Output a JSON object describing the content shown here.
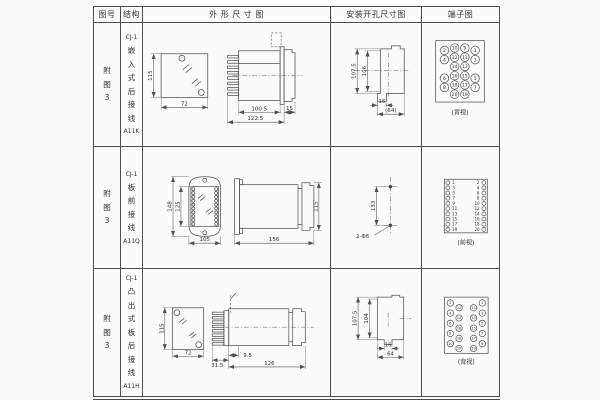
{
  "page": {
    "bg": "#fbfbfb",
    "line_color": "#4d4d4d",
    "text_color": "#2f2f2f"
  },
  "header": {
    "cols": [
      "图号",
      "结构",
      "外 形 尺 寸 图",
      "安装开孔尺寸图",
      "端子图"
    ]
  },
  "rows": [
    {
      "fig": "附\n图\n3",
      "model": "CJ-1",
      "structure": "嵌\n入\n式\n后\n接\n线",
      "code": "A11K",
      "outline": {
        "front_h": "115",
        "front_w": "72",
        "body_w": "100.5",
        "total_w": "122.5",
        "flange": "15"
      },
      "mounting": {
        "outer_h": "107.5",
        "inner_h": "106",
        "tab_w": "16",
        "full_w": "(64)"
      },
      "terminal": {
        "caption": "(背视)",
        "circles_spec": {
          "r": 4.4,
          "font": 4.6,
          "items": [
            {
              "x": 23,
              "y": 27,
              "n": "2"
            },
            {
              "x": 23,
              "y": 36.5,
              "n": "4"
            },
            {
              "x": 23,
              "y": 55.5,
              "n": "6"
            },
            {
              "x": 23,
              "y": 65,
              "n": "8"
            },
            {
              "x": 33.5,
              "y": 24.5,
              "n": "10"
            },
            {
              "x": 33.5,
              "y": 34,
              "n": "12"
            },
            {
              "x": 33.5,
              "y": 43.5,
              "n": "14"
            },
            {
              "x": 33.5,
              "y": 53,
              "n": "16"
            },
            {
              "x": 33.5,
              "y": 62.5,
              "n": "18"
            },
            {
              "x": 33.5,
              "y": 72,
              "n": "20"
            },
            {
              "x": 44,
              "y": 24.5,
              "n": "9"
            },
            {
              "x": 44,
              "y": 34,
              "n": "11"
            },
            {
              "x": 44,
              "y": 43.5,
              "n": "13"
            },
            {
              "x": 44,
              "y": 53,
              "n": "15"
            },
            {
              "x": 44,
              "y": 62.5,
              "n": "17"
            },
            {
              "x": 44,
              "y": 72,
              "n": "19"
            },
            {
              "x": 54.5,
              "y": 27,
              "n": "1"
            },
            {
              "x": 54.5,
              "y": 36.5,
              "n": "3"
            },
            {
              "x": 54.5,
              "y": 55.5,
              "n": "5"
            },
            {
              "x": 54.5,
              "y": 65,
              "n": "7"
            }
          ]
        }
      }
    },
    {
      "fig": "附\n图\n3",
      "model": "CJ-1",
      "structure": "板\n前\n接\n线",
      "code": "A11Q",
      "outline": {
        "outer_h": "148",
        "inner_h": "125",
        "width": "105",
        "side_len": "156",
        "side_h": "115",
        "strips_spec": {
          "r": 1.5,
          "font": 0,
          "items": [
            {
              "x": 50.5,
              "y": 42.5
            },
            {
              "x": 50.5,
              "y": 46.4
            },
            {
              "x": 50.5,
              "y": 50.3
            },
            {
              "x": 50.5,
              "y": 54.2
            },
            {
              "x": 50.5,
              "y": 58.1
            },
            {
              "x": 50.5,
              "y": 62
            },
            {
              "x": 50.5,
              "y": 65.9
            },
            {
              "x": 50.5,
              "y": 69.8
            },
            {
              "x": 50.5,
              "y": 73.7
            },
            {
              "x": 50.5,
              "y": 77.6
            },
            {
              "x": 73.5,
              "y": 42.5
            },
            {
              "x": 73.5,
              "y": 46.4
            },
            {
              "x": 73.5,
              "y": 50.3
            },
            {
              "x": 73.5,
              "y": 54.2
            },
            {
              "x": 73.5,
              "y": 58.1
            },
            {
              "x": 73.5,
              "y": 62
            },
            {
              "x": 73.5,
              "y": 65.9
            },
            {
              "x": 73.5,
              "y": 69.8
            },
            {
              "x": 73.5,
              "y": 73.7
            },
            {
              "x": 73.5,
              "y": 77.6
            }
          ]
        }
      },
      "mounting": {
        "span": "133",
        "holes": "2-Φ6"
      },
      "terminal": {
        "caption": "(前视)",
        "circles_spec": {
          "r": 2,
          "font": 4.2,
          "items": [
            {
              "x": 26.5,
              "y": 35.5,
              "n": "1",
              "tx": 32.5
            },
            {
              "x": 26.5,
              "y": 40.8,
              "n": "3",
              "tx": 32.5
            },
            {
              "x": 26.5,
              "y": 46.2,
              "n": "5",
              "tx": 32.5
            },
            {
              "x": 26.5,
              "y": 51.5,
              "n": "7",
              "tx": 32.5
            },
            {
              "x": 26.5,
              "y": 56.8,
              "n": "9",
              "tx": 32.5
            },
            {
              "x": 26.5,
              "y": 62.2,
              "n": "11",
              "tx": 33.5
            },
            {
              "x": 26.5,
              "y": 67.5,
              "n": "13",
              "tx": 33.5
            },
            {
              "x": 26.5,
              "y": 72.8,
              "n": "15",
              "tx": 33.5
            },
            {
              "x": 26.5,
              "y": 78.2,
              "n": "17",
              "tx": 33.5
            },
            {
              "x": 26.5,
              "y": 83.5,
              "n": "19",
              "tx": 33.5
            },
            {
              "x": 63.5,
              "y": 35.5,
              "n": "2",
              "tx": 57.5
            },
            {
              "x": 63.5,
              "y": 40.8,
              "n": "4",
              "tx": 57.5
            },
            {
              "x": 63.5,
              "y": 46.2,
              "n": "6",
              "tx": 57.5
            },
            {
              "x": 63.5,
              "y": 51.5,
              "n": "8",
              "tx": 57.5
            },
            {
              "x": 63.5,
              "y": 56.8,
              "n": "10",
              "tx": 56.5
            },
            {
              "x": 63.5,
              "y": 62.2,
              "n": "12",
              "tx": 56.5
            },
            {
              "x": 63.5,
              "y": 67.5,
              "n": "14",
              "tx": 56.5
            },
            {
              "x": 63.5,
              "y": 72.8,
              "n": "16",
              "tx": 56.5
            },
            {
              "x": 63.5,
              "y": 78.2,
              "n": "18",
              "tx": 56.5
            },
            {
              "x": 63.5,
              "y": 83.5,
              "n": "20",
              "tx": 56.5
            }
          ]
        }
      }
    },
    {
      "fig": "附\n图\n3",
      "model": "CJ-1",
      "structure": "凸\n出\n式\n板\n后\n接\n线",
      "code": "A11H",
      "outline": {
        "front_h": "115",
        "front_w": "72",
        "pins_w": "31.5",
        "step": "9.5",
        "body_len": "126"
      },
      "mounting": {
        "outer_h": "107.5",
        "inner_h": "104",
        "tab_w": "16",
        "full_w": "64"
      },
      "terminal": {
        "caption": "(背视)",
        "circles_spec": {
          "r": 3.3,
          "font": 3.5,
          "items": [
            {
              "x": 29,
              "y": 34,
              "n": "2"
            },
            {
              "x": 29,
              "y": 44.5,
              "n": "4"
            },
            {
              "x": 29,
              "y": 55,
              "n": "6"
            },
            {
              "x": 29,
              "y": 65.5,
              "n": "8"
            },
            {
              "x": 29,
              "y": 76,
              "n": "10"
            },
            {
              "x": 38,
              "y": 39,
              "n": "12"
            },
            {
              "x": 38,
              "y": 49.5,
              "n": "14"
            },
            {
              "x": 38,
              "y": 60,
              "n": "16"
            },
            {
              "x": 38,
              "y": 70.5,
              "n": "18"
            },
            {
              "x": 38,
              "y": 81,
              "n": "20"
            },
            {
              "x": 53,
              "y": 39,
              "n": "11"
            },
            {
              "x": 53,
              "y": 49.5,
              "n": "13"
            },
            {
              "x": 53,
              "y": 60,
              "n": "15"
            },
            {
              "x": 53,
              "y": 70.5,
              "n": "17"
            },
            {
              "x": 53,
              "y": 81,
              "n": "19"
            },
            {
              "x": 62,
              "y": 34,
              "n": "1"
            },
            {
              "x": 62,
              "y": 44.5,
              "n": "3"
            },
            {
              "x": 62,
              "y": 55,
              "n": "5"
            },
            {
              "x": 62,
              "y": 65.5,
              "n": "7"
            },
            {
              "x": 62,
              "y": 76,
              "n": "9"
            }
          ]
        }
      }
    }
  ]
}
